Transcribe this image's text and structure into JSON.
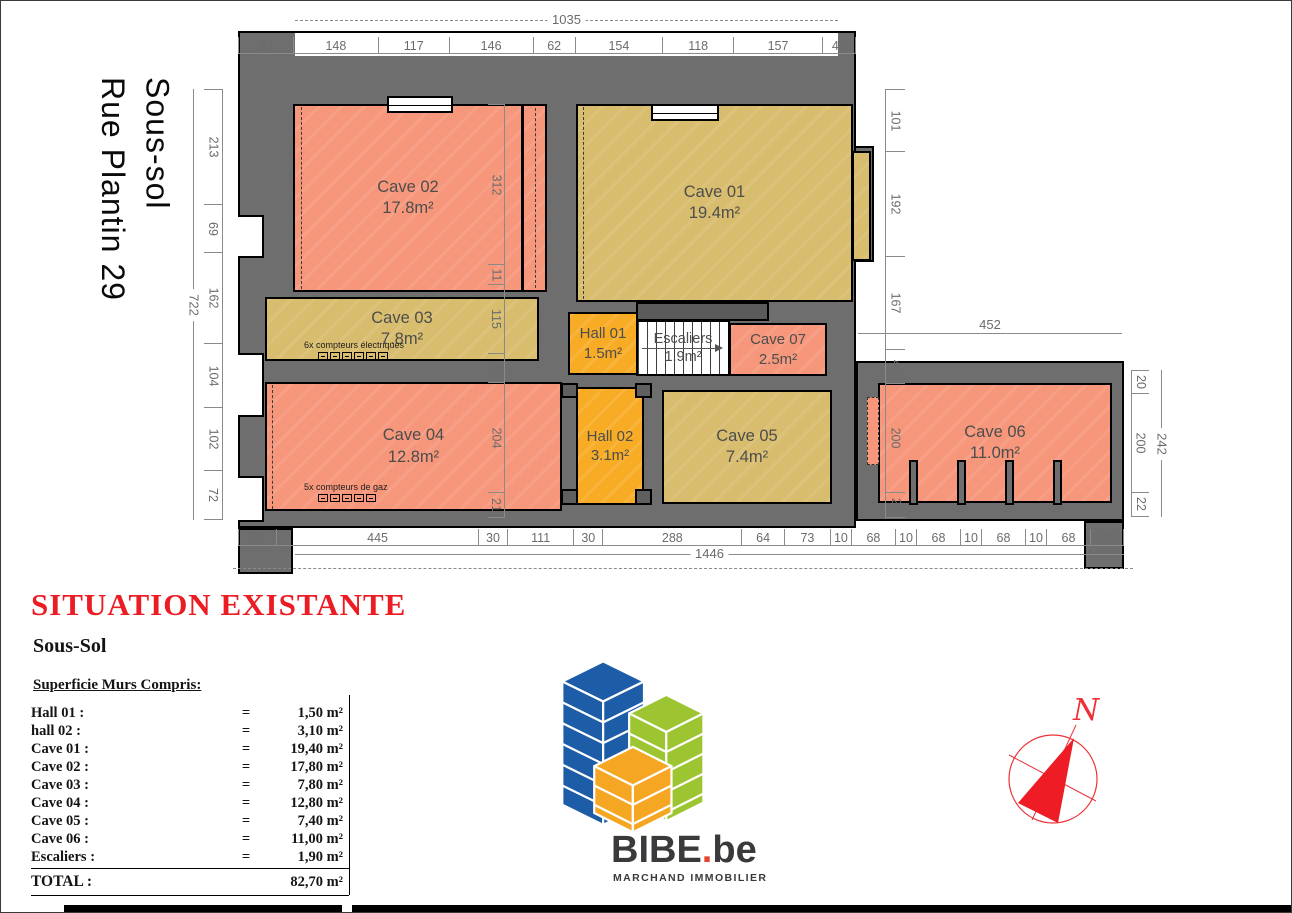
{
  "plan": {
    "vertical_title": {
      "line1": "Sous-sol",
      "line2": "Rue Plantin 29"
    },
    "rooms": {
      "cave01": {
        "name": "Cave 01",
        "area": "19.4m²"
      },
      "cave02": {
        "name": "Cave 02",
        "area": "17.8m²"
      },
      "cave03": {
        "name": "Cave 03",
        "area": "7.8m²"
      },
      "cave04": {
        "name": "Cave 04",
        "area": "12.8m²"
      },
      "cave05": {
        "name": "Cave 05",
        "area": "7.4m²"
      },
      "cave06": {
        "name": "Cave 06",
        "area": "11.0m²"
      },
      "cave07": {
        "name": "Cave 07",
        "area": "2.5m²"
      },
      "hall01": {
        "name": "Hall 01",
        "area": "1.5m²"
      },
      "hall02": {
        "name": "Hall 02",
        "area": "3.1m²"
      }
    },
    "stairs": {
      "name": "Escaliers",
      "area": "1.9m²"
    },
    "annotations": {
      "electric": "6x compteurs électriques",
      "gas": "5x compteurs de gaz"
    },
    "dims": {
      "top_total": "1035",
      "top": [
        "93",
        "148",
        "117",
        "146",
        "62",
        "154",
        "118",
        "157",
        "40"
      ],
      "left_total": "722",
      "left": [
        "213",
        "69",
        "162",
        "104",
        "102",
        "72"
      ],
      "right": [
        "101",
        "192",
        "167",
        "40",
        "200",
        "22"
      ],
      "interior": [
        "312",
        "11",
        "115",
        "32",
        "204",
        "21"
      ],
      "wing_top": "452",
      "far_right": [
        "20",
        "200",
        "22"
      ],
      "far_right_total": "242",
      "bottom": [
        "53",
        "445",
        "30",
        "111",
        "30",
        "288",
        "64",
        "73",
        "10",
        "68",
        "10",
        "68",
        "10",
        "68",
        "10",
        "68",
        "40"
      ],
      "bottom_total": "1446"
    }
  },
  "legend": {
    "title": "SITUATION EXISTANTE",
    "subtitle": "Sous-Sol",
    "section": "Superficie Murs Compris:",
    "eq": "=",
    "rows": [
      {
        "label": "Hall 01 :",
        "value": "1,50 m²"
      },
      {
        "label": "hall 02 :",
        "value": "3,10 m²"
      },
      {
        "label": "Cave 01 :",
        "value": "19,40 m²"
      },
      {
        "label": "Cave 02 :",
        "value": "17,80 m²"
      },
      {
        "label": "Cave 03 :",
        "value": "7,80 m²"
      },
      {
        "label": "Cave 04 :",
        "value": "12,80 m²"
      },
      {
        "label": "Cave 05 :",
        "value": "7,40 m²"
      },
      {
        "label": "Cave 06 :",
        "value": "11,00 m²"
      },
      {
        "label": "Escaliers :",
        "value": "1,90 m²"
      }
    ],
    "total_label": "TOTAL :",
    "total_value": "82,70 m²"
  },
  "logo": {
    "brand": "BIBE",
    "dot": ".",
    "tld": "be",
    "tagline": "MARCHAND IMMOBILIER"
  },
  "compass": {
    "north_label": "N"
  },
  "colors": {
    "wall": "#6E6E6E",
    "room_salmon": "#F6977B",
    "room_tan": "#D9BD6E",
    "room_amber": "#F8AC25",
    "title_red": "#EC1C24",
    "logo_blue": "#1D5CA6",
    "logo_green": "#9CC531",
    "logo_orange": "#F5A623",
    "compass_red": "#ED1C25"
  }
}
